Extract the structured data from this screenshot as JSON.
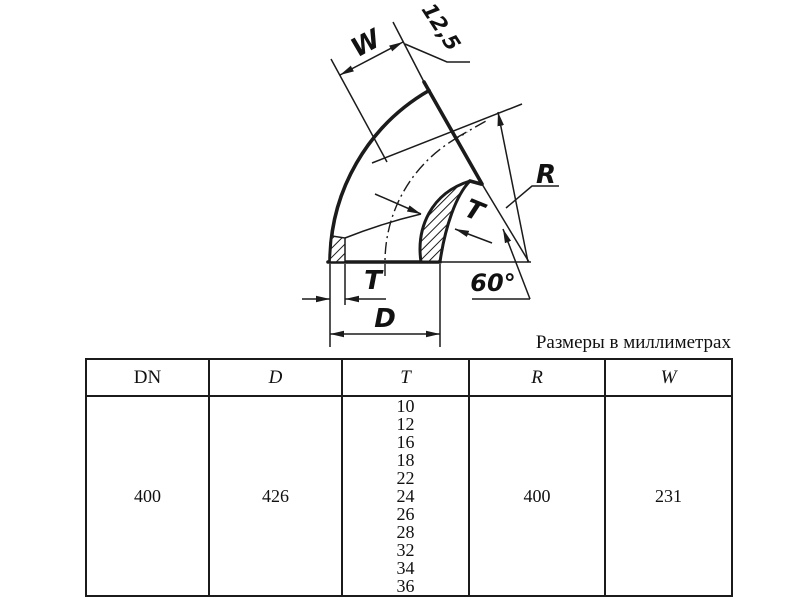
{
  "caption": "Размеры в миллиметрах",
  "drawing": {
    "labels": {
      "w": "W",
      "roughness": "12,5",
      "r": "R",
      "t_mid": "T",
      "angle": "60°",
      "t_bottom": "T",
      "d": "D"
    }
  },
  "table": {
    "columns": [
      "DN",
      "D",
      "T",
      "R",
      "W"
    ],
    "row": {
      "dn": "400",
      "d": "426",
      "t_values": [
        "10",
        "12",
        "16",
        "18",
        "22",
        "24",
        "26",
        "28",
        "32",
        "34",
        "36"
      ],
      "r": "400",
      "w": "231"
    }
  }
}
